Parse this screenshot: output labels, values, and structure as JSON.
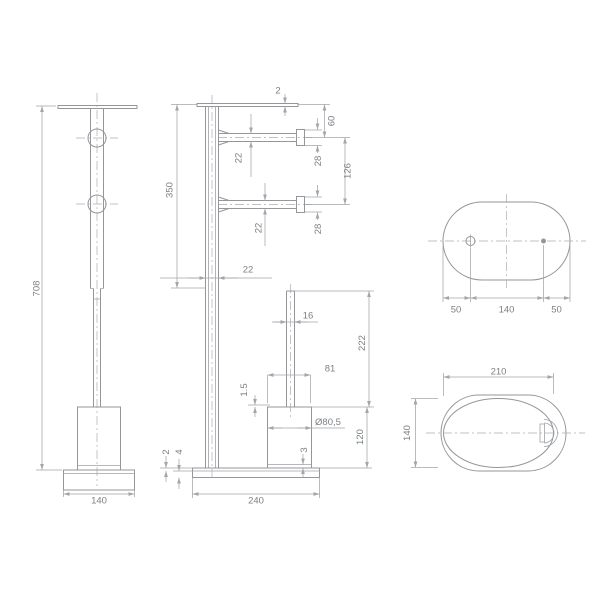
{
  "drawing_title": "freestanding toilet brush and paper holder dimension drawing",
  "colors": {
    "background": "#ffffff",
    "geometry_line": "#94969a",
    "dimension_line": "#a3a5a8",
    "text": "#7d8083"
  },
  "views": {
    "front": {
      "dims": {
        "overall_height": "708",
        "base_width": "140"
      }
    },
    "side": {
      "dims": {
        "top_plate_thickness": "2",
        "upper_pole_length": "350",
        "pole_width": "22",
        "arm_top_offset": "60",
        "arm1_flange": "28",
        "arm_spacing": "126",
        "arm2_flange": "28",
        "arm1_diameter": "22",
        "arm2_diameter": "22",
        "handle_diameter": "16",
        "handle_length": "222",
        "cup_rim_width": "81",
        "cup_rim_lip": "1.5",
        "cup_diameter": "Ø80,5",
        "cup_height": "120",
        "cup_bottom_gap": "3",
        "base_plate_thickness": "2",
        "base_height": "4",
        "base_length": "240"
      }
    },
    "top": {
      "dims": {
        "left_offset": "50",
        "hole_spacing": "140",
        "right_offset": "50"
      }
    },
    "plan": {
      "dims": {
        "length": "210",
        "depth": "140"
      }
    }
  }
}
